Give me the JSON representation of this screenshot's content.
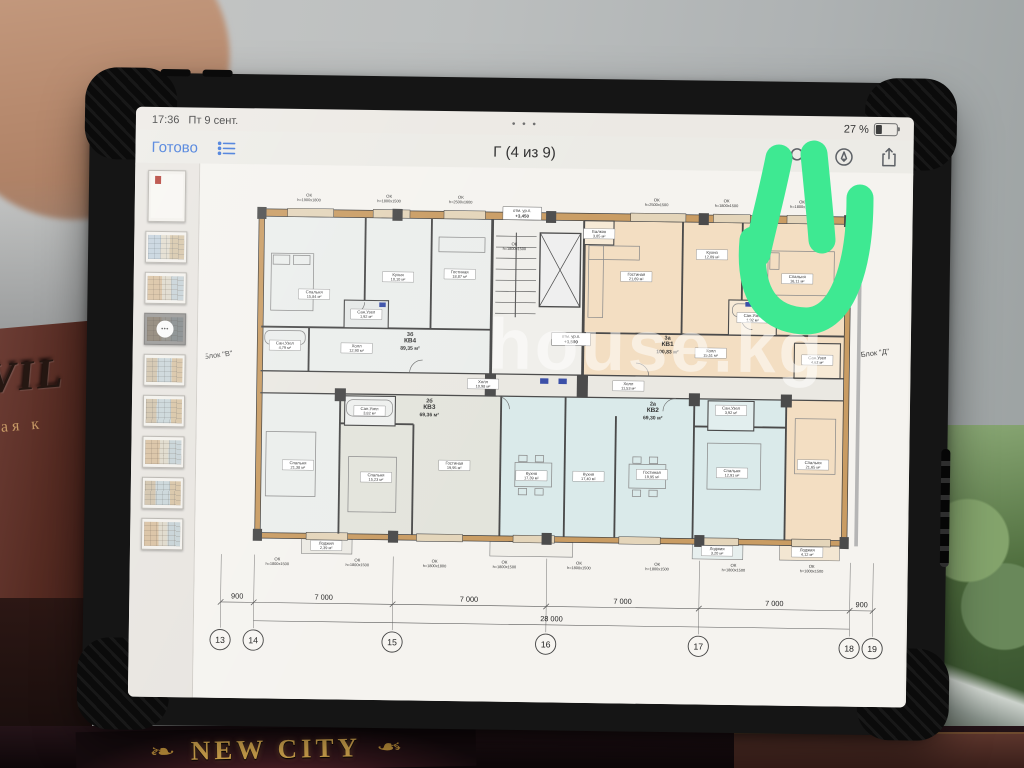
{
  "status": {
    "time": "17:36",
    "date": "Пт 9 сент.",
    "battery": "27 %",
    "window_dots": "• • •"
  },
  "toolbar": {
    "done": "Готово",
    "title": "Г (4 из 9)"
  },
  "sidebar": {
    "selected_dots": "•••",
    "thumbnails": [
      {
        "kind": "cover",
        "tint": "cover",
        "selected": false
      },
      {
        "kind": "plan",
        "tint": "t-cool",
        "selected": false
      },
      {
        "kind": "plan",
        "tint": "t-warm",
        "selected": false
      },
      {
        "kind": "plan",
        "tint": "t-warm",
        "selected": true
      },
      {
        "kind": "plan",
        "tint": "t-mixed",
        "selected": false
      },
      {
        "kind": "plan",
        "tint": "t-mixed",
        "selected": false
      },
      {
        "kind": "plan",
        "tint": "t-warm",
        "selected": false
      },
      {
        "kind": "plan",
        "tint": "t-mixed",
        "selected": false
      },
      {
        "kind": "plan",
        "tint": "t-warm",
        "selected": false
      }
    ]
  },
  "plan": {
    "watermark": "house.kg",
    "block_left": "Блок \"В\"",
    "block_right": "Блок \"Д\"",
    "window_prefix": "ОК",
    "windows": [
      {
        "s": "h=1900x1800",
        "x": 98,
        "y": 6
      },
      {
        "s": "h=1800x1500",
        "x": 185,
        "y": 6
      },
      {
        "s": "h=2500x1600",
        "x": 263,
        "y": 6
      },
      {
        "s": "h=2500x1500",
        "x": 476,
        "y": 6
      },
      {
        "s": "h=1800x1500",
        "x": 552,
        "y": 6
      },
      {
        "s": "h=1800x1500",
        "x": 634,
        "y": 6
      },
      {
        "s": "h=1800x1500",
        "x": 322,
        "y": 56
      },
      {
        "s": "h=1800x1500",
        "x": 69,
        "y": 402
      },
      {
        "s": "h=1800x1500",
        "x": 156,
        "y": 402
      },
      {
        "s": "h=1800x1800",
        "x": 240,
        "y": 402
      },
      {
        "s": "h=1800x1500",
        "x": 316,
        "y": 402
      },
      {
        "s": "h=1800x1500",
        "x": 397,
        "y": 402
      },
      {
        "s": "h=1800x1500",
        "x": 482,
        "y": 402
      },
      {
        "s": "h=1800x1500",
        "x": 565,
        "y": 402
      },
      {
        "s": "h=1800x1500",
        "x": 650,
        "y": 402
      }
    ],
    "rooms": [
      {
        "name": "Спальня",
        "area": "15,84 м²",
        "x": 105,
        "y": 112
      },
      {
        "name": "Кухня",
        "area": "10,10 м²",
        "x": 196,
        "y": 92
      },
      {
        "name": "Гостиная",
        "area": "18,87 м²",
        "x": 263,
        "y": 88
      },
      {
        "name": "Сан.Узел",
        "area": "1,92 м²",
        "x": 162,
        "y": 133
      },
      {
        "name": "Сан.Узел",
        "area": "4,79 м²",
        "x": 74,
        "y": 168
      },
      {
        "name": "Холл",
        "area": "12,90 м²",
        "x": 152,
        "y": 170
      },
      {
        "name": "Балкон",
        "area": "3,85 м²",
        "x": 414,
        "y": 42
      },
      {
        "name": "Гостиная",
        "area": "21,69 м²",
        "x": 455,
        "y": 88
      },
      {
        "name": "Кухня",
        "area": "12,09 м²",
        "x": 537,
        "y": 63
      },
      {
        "name": "Спальня",
        "area": "16,11 м²",
        "x": 630,
        "y": 88
      },
      {
        "name": "Сан.Узел",
        "area": "1,92 м²",
        "x": 582,
        "y": 131
      },
      {
        "name": "Холл",
        "area": "15,51 м²",
        "x": 537,
        "y": 170
      },
      {
        "name": "Сан.Узел",
        "area": "4,62 м²",
        "x": 653,
        "y": 176
      },
      {
        "name": "Спальня",
        "area": "21,38 м²",
        "x": 90,
        "y": 298
      },
      {
        "name": "Сан.Узел",
        "area": "3,82 м²",
        "x": 167,
        "y": 238
      },
      {
        "name": "Спальня",
        "area": "15,23 м²",
        "x": 175,
        "y": 310
      },
      {
        "name": "Гостиная",
        "area": "19,95 м²",
        "x": 260,
        "y": 296
      },
      {
        "name": "Холл",
        "area": "10,98 м²",
        "x": 290,
        "y": 207
      },
      {
        "name": "Кухня",
        "area": "17,39 м²",
        "x": 344,
        "y": 306
      },
      {
        "name": "Лоджия",
        "area": "2,39 м²",
        "x": 122,
        "y": 385
      },
      {
        "name": "Холл",
        "area": "11,53 м²",
        "x": 448,
        "y": 207
      },
      {
        "name": "Сан.Узел",
        "area": "3,92 м²",
        "x": 560,
        "y": 232
      },
      {
        "name": "Гостиная",
        "area": "19,95 м²",
        "x": 475,
        "y": 303
      },
      {
        "name": "Кухня",
        "area": "17,40 м²",
        "x": 406,
        "y": 306
      },
      {
        "name": "Спальня",
        "area": "12,91 м²",
        "x": 562,
        "y": 300
      },
      {
        "name": "Лоджия",
        "area": "3,20 м²",
        "x": 547,
        "y": 385
      },
      {
        "name": "Спальня",
        "area": "21,65 м²",
        "x": 650,
        "y": 290
      },
      {
        "name": "Лоджия",
        "area": "4,12 м²",
        "x": 645,
        "y": 385
      }
    ],
    "apartments": [
      {
        "type": "3б",
        "kv": "КВ4",
        "area": "89,35 м²",
        "x": 210,
        "y": 163
      },
      {
        "type": "3а",
        "kv": "КВ1",
        "area": "100,83 м²",
        "x": 490,
        "y": 163
      },
      {
        "type": "2б",
        "kv": "КВ3",
        "area": "69,36 м²",
        "x": 232,
        "y": 235
      },
      {
        "type": "2а",
        "kv": "КВ2",
        "area": "69,30 м²",
        "x": 475,
        "y": 235
      }
    ],
    "elevations": [
      {
        "label": "отм. ур.п.",
        "value": "+3,450",
        "x": 330,
        "y": 20
      },
      {
        "label": "отм. ур.п.",
        "value": "+3,500",
        "x": 385,
        "y": 156
      }
    ],
    "dimensions": {
      "segments": [
        {
          "t": "900",
          "x": 26
        },
        {
          "t": "7 000",
          "x": 120
        },
        {
          "t": "7 000",
          "x": 278
        },
        {
          "t": "7 000",
          "x": 445
        },
        {
          "t": "7 000",
          "x": 610
        },
        {
          "t": "900",
          "x": 705
        }
      ],
      "total": {
        "t": "28 000",
        "x": 368
      },
      "grid": [
        {
          "n": "13",
          "x": 8
        },
        {
          "n": "14",
          "x": 44
        },
        {
          "n": "15",
          "x": 195
        },
        {
          "n": "16",
          "x": 362
        },
        {
          "n": "17",
          "x": 528
        },
        {
          "n": "18",
          "x": 692
        },
        {
          "n": "19",
          "x": 717
        }
      ]
    }
  },
  "background": {
    "book_emboss": "VIL",
    "book_line": "ная к",
    "box_title": "NEW CITY"
  }
}
